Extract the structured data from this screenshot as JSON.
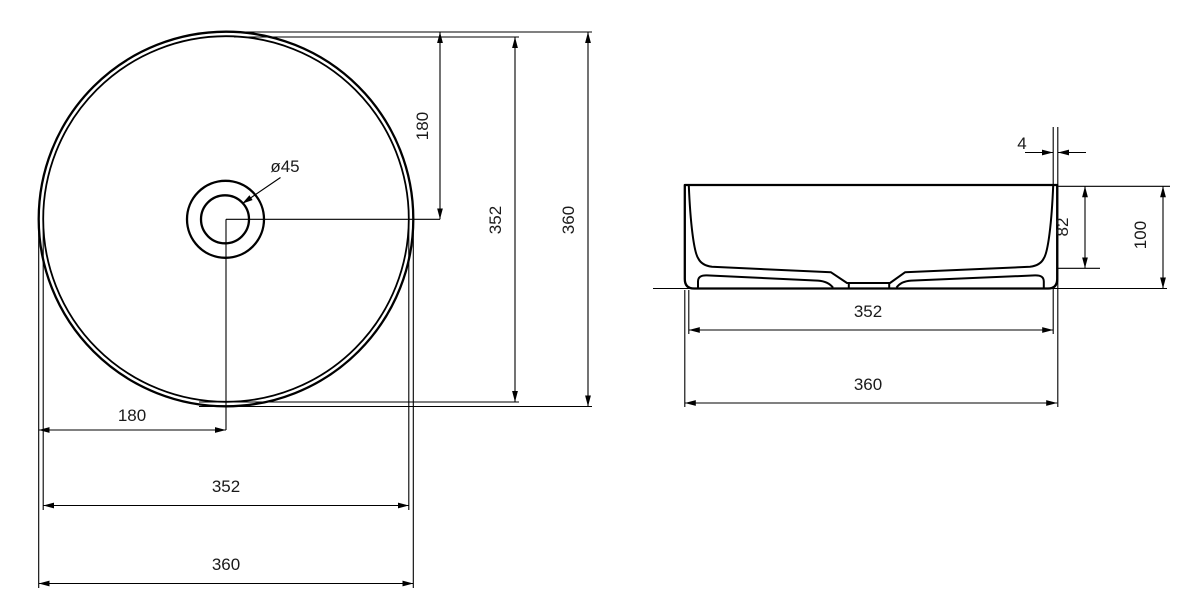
{
  "drawing_title": "round washbasin dimension drawing",
  "colors": {
    "background": "#ffffff",
    "line": "#000000",
    "text": "#1a1a1a"
  },
  "top_view": {
    "name": "top view",
    "center_offset_vertical": "180",
    "inner_diameter_vertical": "352",
    "outer_diameter_vertical": "360",
    "drain_diameter": "ø45",
    "center_offset_horizontal": "180",
    "inner_diameter_horizontal": "352",
    "outer_diameter_horizontal": "360"
  },
  "side_view": {
    "name": "side view",
    "rim_thickness": "4",
    "inner_depth": "82",
    "overall_height": "100",
    "inner_width": "352",
    "outer_width": "360"
  }
}
